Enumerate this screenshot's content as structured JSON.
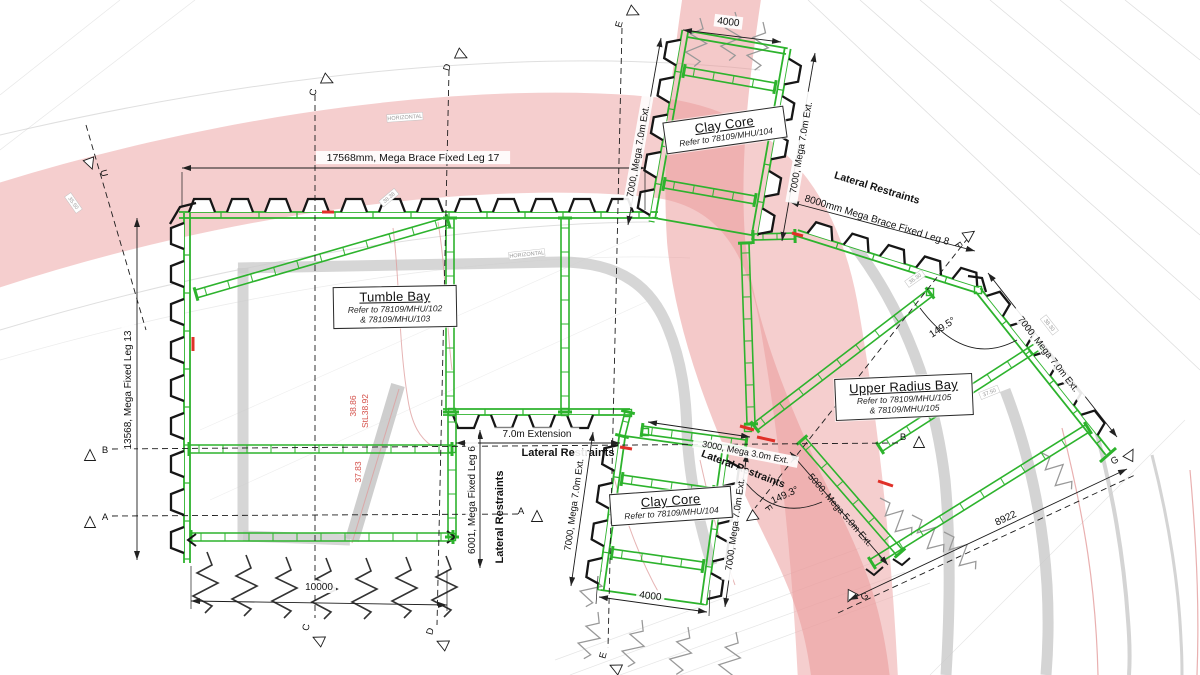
{
  "page": {
    "background": "#ffffff"
  },
  "colors": {
    "structure_green": "#2db32d",
    "linework_black": "#1c1c1c",
    "alignment_pink": "#efadad",
    "alignment_red": "#ea9393",
    "accent_red": "#e03028",
    "level_red": "#d4504a",
    "channel_gray": "#cccccc"
  },
  "bays": [
    {
      "title": "Tumble Bay",
      "ref1": "Refer to 78109/MHU/102",
      "ref2": "& 78109/MHU/103"
    },
    {
      "title": "Clay Core",
      "ref1": "Refer to 78109/MHU/104",
      "ref2": ""
    },
    {
      "title": "Clay Core",
      "ref1": "Refer to 78109/MHU/104",
      "ref2": ""
    },
    {
      "title": "Upper Radius Bay",
      "ref1": "Refer to 78109/MHU/105",
      "ref2": "& 78109/MHU/105"
    }
  ],
  "dims": {
    "top_brace": "17568mm, Mega Brace Fixed Leg 17",
    "left_leg": "13568, Mega Fixed Leg 13",
    "leg6": "6001, Mega Fixed Leg 6",
    "extension_70": "7.0m Extension",
    "mega70": "7000, Mega 7.0m Ext.",
    "mega50": "5000, Mega 5.0m Ext.",
    "mega30": "3000, Mega 3.0m Ext.",
    "brace8": "8000mm Mega Brace Fixed Leg 8",
    "d4000": "4000",
    "d10000": "10000",
    "d8922": "8922",
    "angle_a": "149.5°",
    "angle_b": "149.3°"
  },
  "notes": {
    "lateral": "Lateral Restraints"
  },
  "levels": [
    "38.86",
    "StL38.92",
    "37.83"
  ],
  "survey_tags": [
    "HORIZONTAL",
    "HORIZONTAL",
    "38.38",
    "36.30",
    "37.50",
    "38.30",
    "35.50"
  ],
  "markers": [
    "U",
    "C",
    "D",
    "E",
    "B",
    "A",
    "A",
    "B",
    "C",
    "D",
    "E",
    "F",
    "F",
    "G",
    "G"
  ]
}
